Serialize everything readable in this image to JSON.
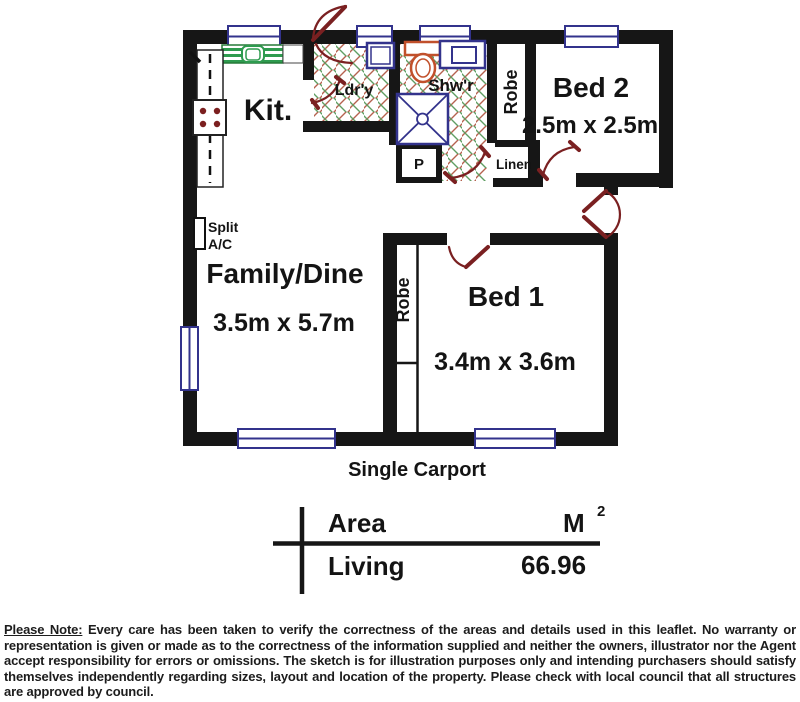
{
  "floorplan": {
    "labels": {
      "kitchen": "Kit.",
      "laundry": "Ldr'y",
      "shower": "Shw'r",
      "pantry": "P",
      "linen": "Linen",
      "robe": "Robe",
      "bed2": "Bed 2",
      "bed2_dims": "2.5m x 2.5m",
      "family": "Family/Dine",
      "family_dims": "3.5m x 5.7m",
      "bed1": "Bed 1",
      "bed1_dims": "3.4m x 3.6m",
      "split_ac_line1": "Split",
      "split_ac_line2": "A/C",
      "carport": "Single Carport"
    },
    "colors": {
      "wall": "#161616",
      "door": "#7a2021",
      "window_frame": "#33338c",
      "bench_green": "#2e9b4f",
      "toilet_orange": "#c1502b",
      "hatch_red": "#b5624f",
      "hatch_green": "#5f9e63"
    }
  },
  "area_table": {
    "header": "Area",
    "unit": "M",
    "unit_sup": "2",
    "rows": [
      {
        "name": "Living",
        "value": "66.96"
      }
    ]
  },
  "disclaimer": {
    "label": "Please Note:",
    "text": "Every care has  been  taken to verify  the correctness of the areas and   details used in  this leaflet. No warranty  or representation  is given or made as to the correctness of the information supplied  and neither the owners, illustrator nor the Agent  accept  responsibility for errors or omissions. The sketch is  for illustration purposes only and intending purchasers should satisfy themselves independently  regarding sizes, layout and location of the property.  Please check with local council that all structures are approved by council."
  }
}
